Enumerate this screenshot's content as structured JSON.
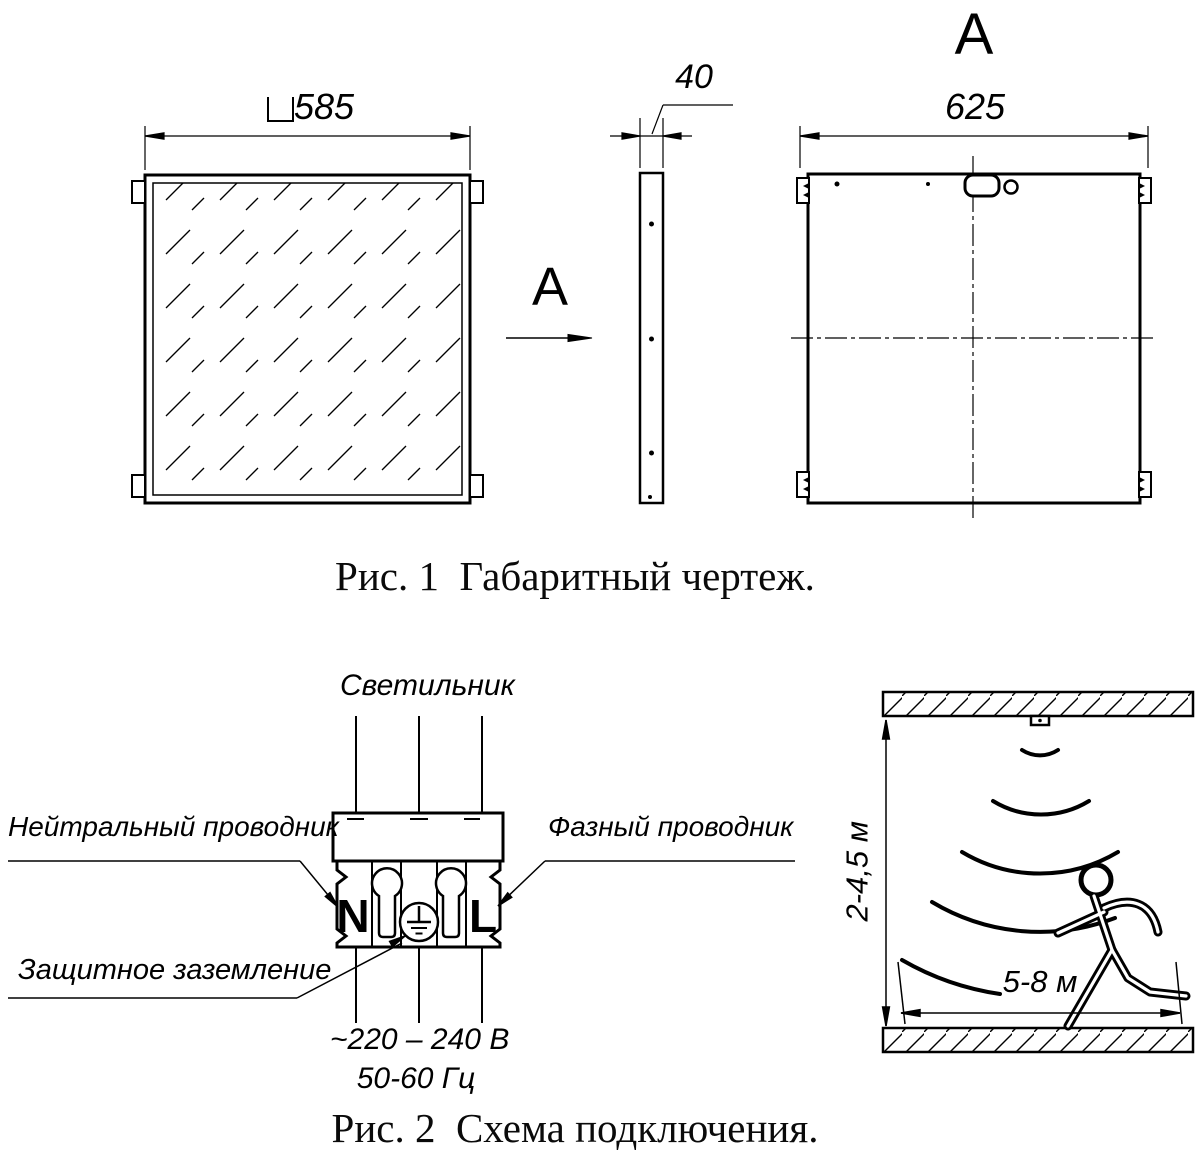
{
  "figure1": {
    "caption": "Рис. 1  Габаритный чертеж.",
    "front_width_dim": "585",
    "side_thickness_dim": "40",
    "rear_width_dim": "625",
    "rear_view_title": "А",
    "section_arrow_label": "А"
  },
  "figure2": {
    "caption": "Рис. 2  Схема подключения.",
    "luminaire_label": "Светильник",
    "neutral_conductor_label": "Нейтральный проводник",
    "phase_conductor_label": "Фазный проводник",
    "protective_earth_label": "Защитное заземление",
    "terminal_neutral": "N",
    "terminal_line": "L",
    "supply_voltage": "~220 – 240 В",
    "supply_frequency": "50-60 Гц",
    "mount_height_range": "2-4,5 м",
    "detection_distance_range": "5-8 м"
  },
  "colors": {
    "ink": "#000000",
    "paper": "#ffffff"
  }
}
